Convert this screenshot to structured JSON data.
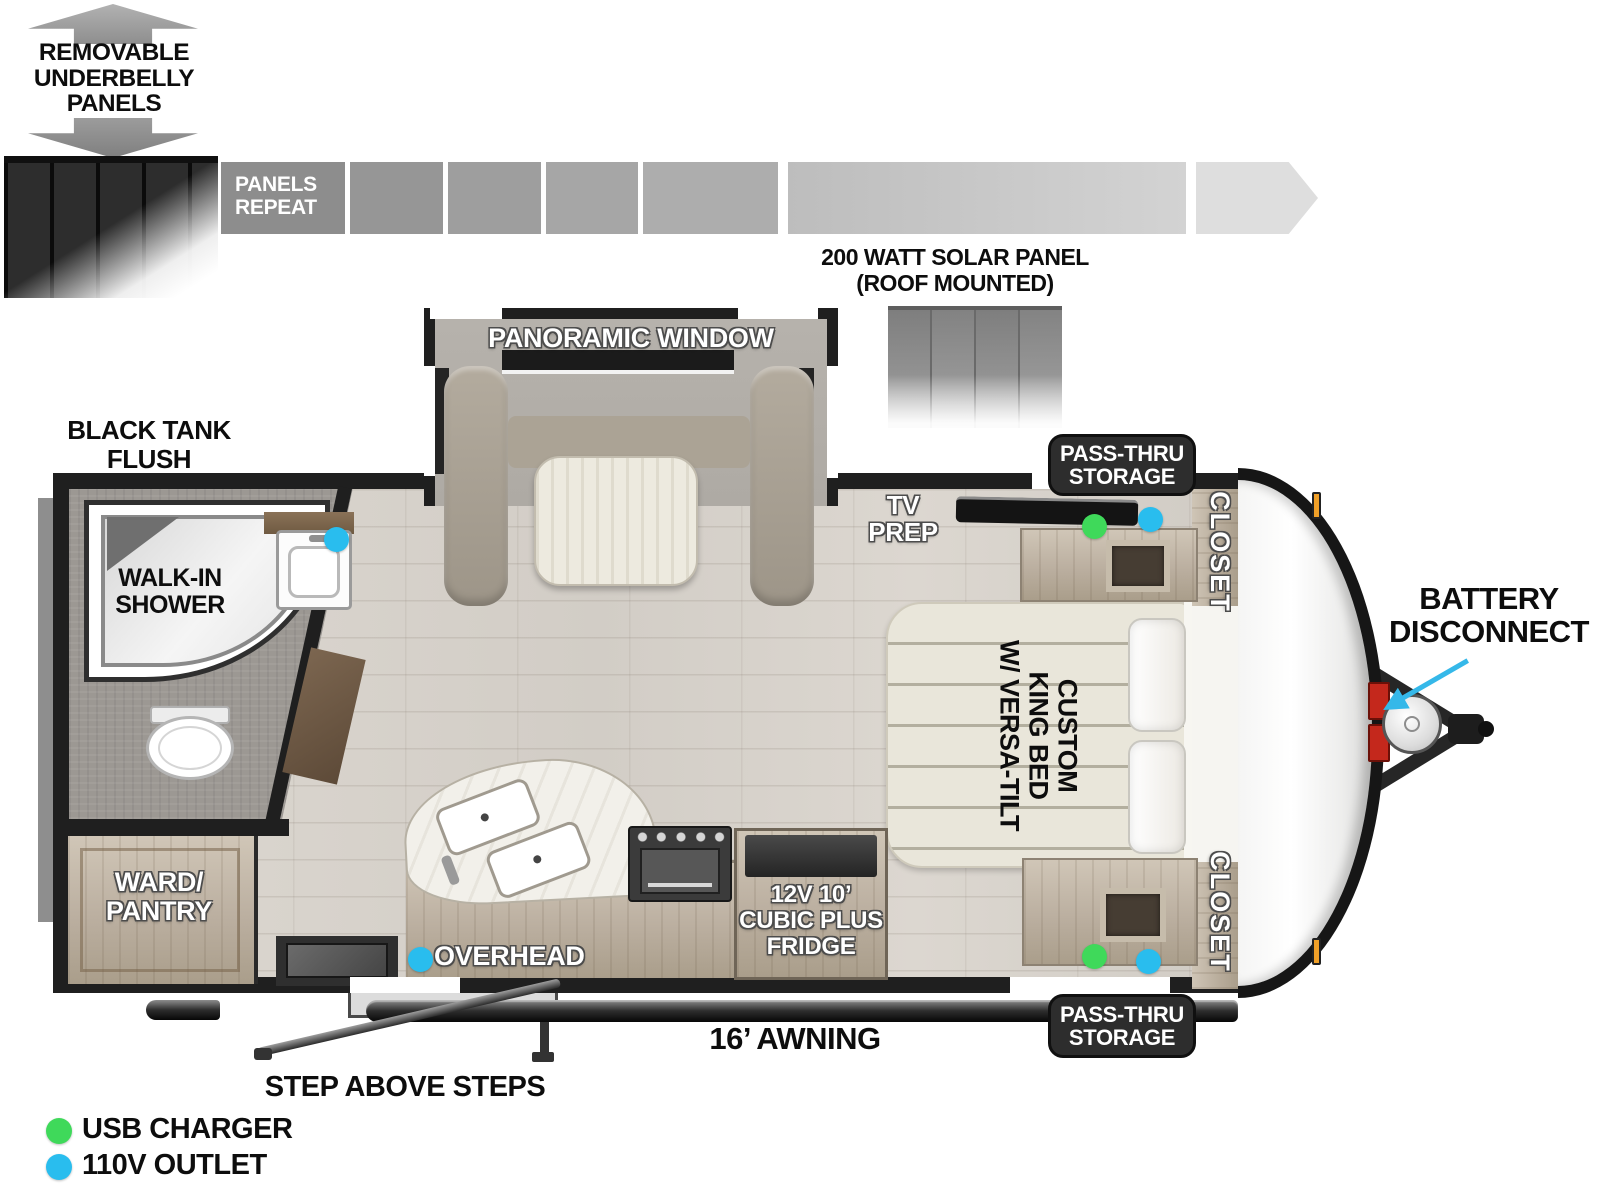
{
  "underbelly": {
    "label": "REMOVABLE\nUNDERBELLY\nPANELS",
    "panels_repeat": "PANELS\nREPEAT"
  },
  "solar": {
    "label": "200 WATT SOLAR PANEL\n(ROOF MOUNTED)"
  },
  "rooms": {
    "panoramic_window": "PANORAMIC WINDOW",
    "black_tank_flush": "BLACK TANK\nFLUSH",
    "walk_in_shower": "WALK-IN\nSHOWER",
    "tv_prep": "TV\nPREP",
    "pass_thru_storage_top": "PASS-THRU\nSTORAGE",
    "pass_thru_storage_bottom": "PASS-THRU\nSTORAGE",
    "closet_top": "CLOSET",
    "closet_bottom": "CLOSET",
    "king_bed": "CUSTOM\nKING BED\nW/ VERSA-TILT",
    "ward_pantry": "WARD/\nPANTRY",
    "overhead": "OVERHEAD",
    "fridge": "12V 10’\nCUBIC PLUS\nFRIDGE"
  },
  "exterior": {
    "battery_disconnect": "BATTERY\nDISCONNECT",
    "awning": "16’ AWNING",
    "steps": "STEP ABOVE STEPS"
  },
  "legend": {
    "usb_charger": {
      "label": "USB CHARGER",
      "color": "#3fd95a"
    },
    "outlet_110v": {
      "label": "110V OUTLET",
      "color": "#29bdee"
    }
  },
  "colors": {
    "pointer_arrow": "#35b8e9",
    "wall": "#1f1f1f"
  }
}
